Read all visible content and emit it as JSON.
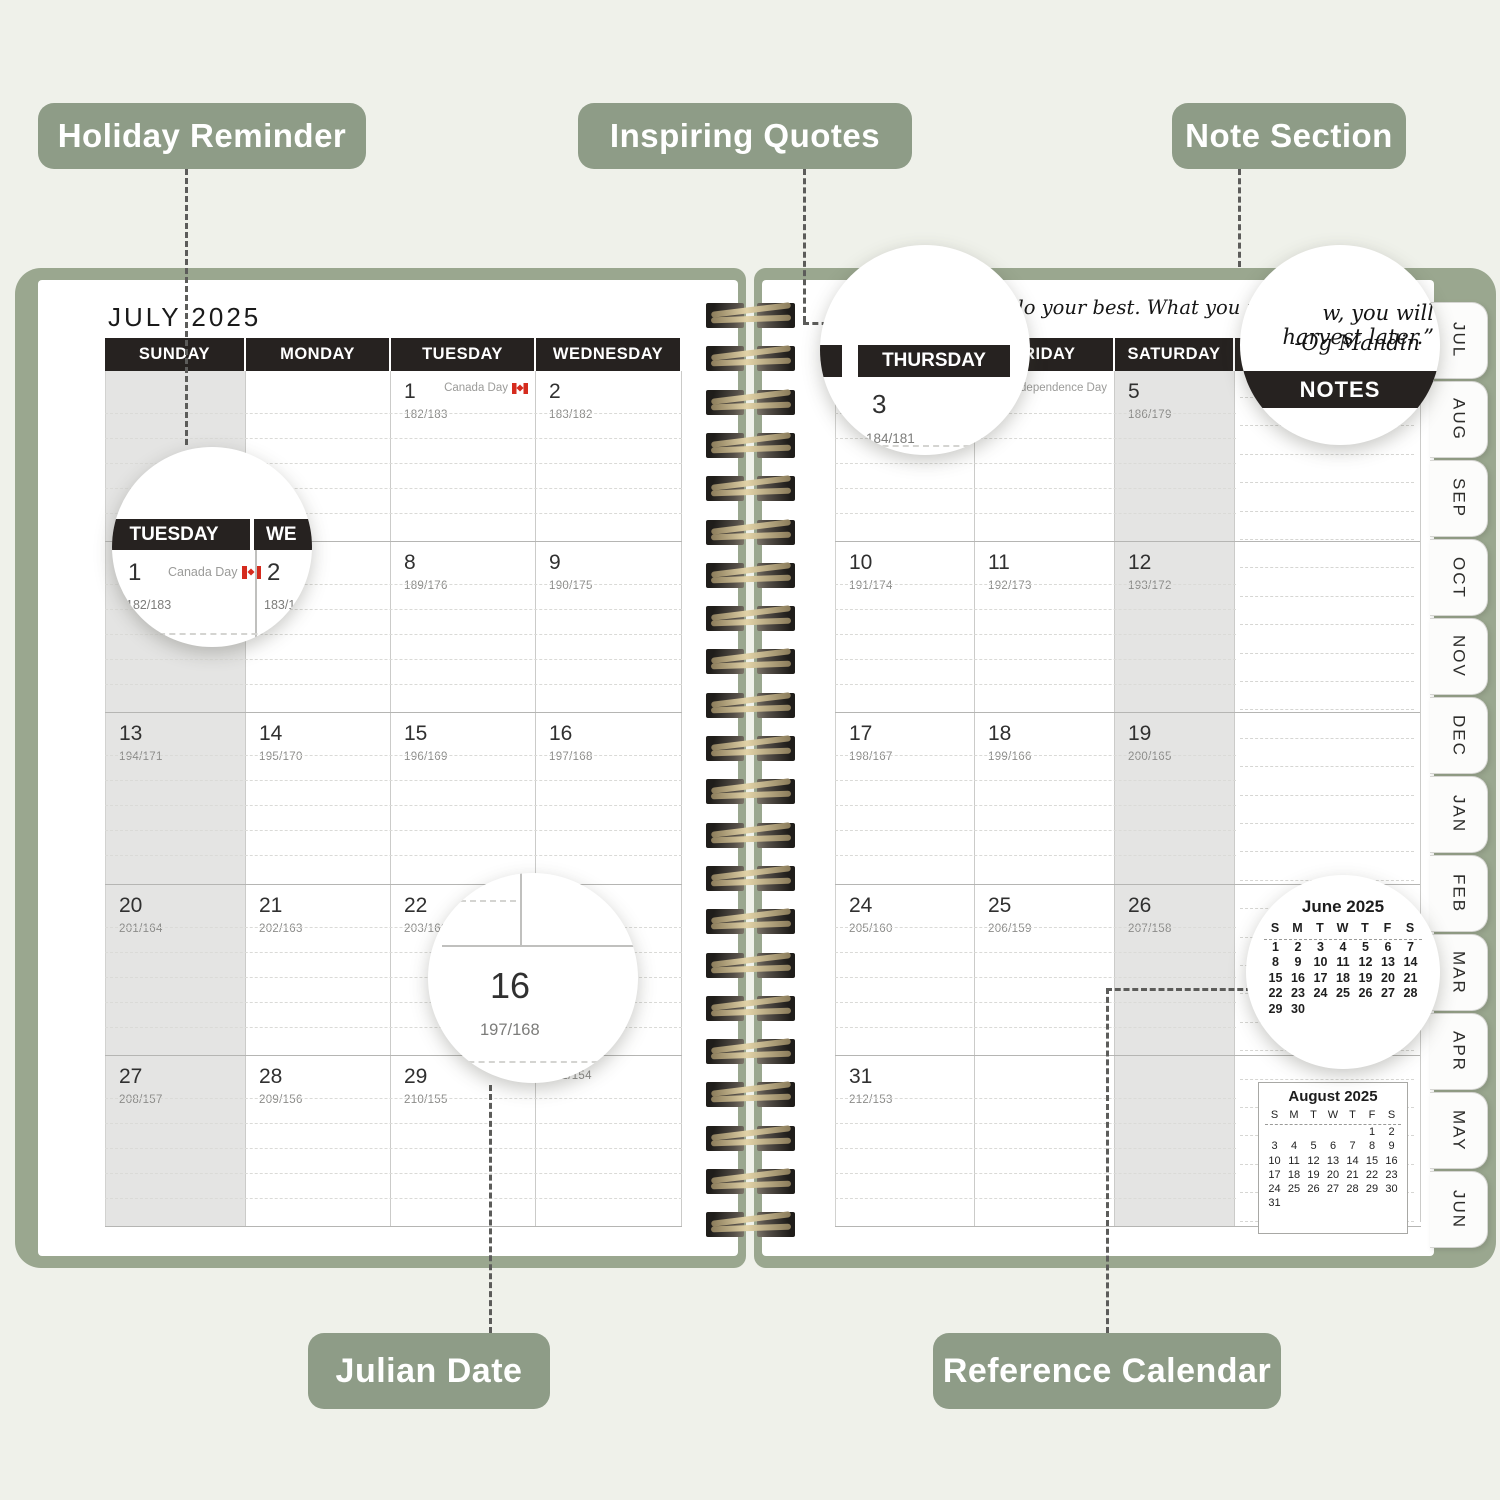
{
  "callouts": {
    "holiday_reminder": "Holiday Reminder",
    "inspiring_quotes": "Inspiring Quotes",
    "note_section": "Note Section",
    "julian_date": "Julian Date",
    "reference_calendar": "Reference Calendar"
  },
  "colors": {
    "background": "#eff1ea",
    "label_sage": "#8e9c87",
    "cover_sage": "#9aa78f",
    "header_bar": "#262220",
    "shaded_column": "#e4e4e3",
    "flag_red": "#d52b1e"
  },
  "left_page": {
    "title": "JULY 2025",
    "day_headers": [
      "SUNDAY",
      "MONDAY",
      "TUESDAY",
      "WEDNESDAY"
    ],
    "rows": [
      [
        {
          "day": "",
          "julian": "",
          "holiday": ""
        },
        {
          "day": "",
          "julian": "",
          "holiday": ""
        },
        {
          "day": "1",
          "julian": "182/183",
          "holiday": "Canada Day",
          "flag": true
        },
        {
          "day": "2",
          "julian": "183/182",
          "holiday": ""
        }
      ],
      [
        {
          "day": "",
          "julian": "",
          "holiday": ""
        },
        {
          "day": "",
          "julian": "",
          "holiday": ""
        },
        {
          "day": "8",
          "julian": "189/176",
          "holiday": ""
        },
        {
          "day": "9",
          "julian": "190/175",
          "holiday": ""
        }
      ],
      [
        {
          "day": "13",
          "julian": "194/171",
          "holiday": ""
        },
        {
          "day": "14",
          "julian": "195/170",
          "holiday": ""
        },
        {
          "day": "15",
          "julian": "196/169",
          "holiday": ""
        },
        {
          "day": "16",
          "julian": "197/168",
          "holiday": ""
        }
      ],
      [
        {
          "day": "20",
          "julian": "201/164",
          "holiday": ""
        },
        {
          "day": "21",
          "julian": "202/163",
          "holiday": ""
        },
        {
          "day": "22",
          "julian": "203/162",
          "holiday": ""
        },
        {
          "day": "",
          "julian": "",
          "holiday": ""
        }
      ],
      [
        {
          "day": "27",
          "julian": "208/157",
          "holiday": ""
        },
        {
          "day": "28",
          "julian": "209/156",
          "holiday": ""
        },
        {
          "day": "29",
          "julian": "210/155",
          "holiday": ""
        },
        {
          "day": "",
          "julian": "211/154",
          "holiday": ""
        }
      ]
    ]
  },
  "right_page": {
    "quote_fragment": "s do your best. What you plant",
    "day_headers": [
      "THURSDAY",
      "FRIDAY",
      "SATURDAY"
    ],
    "notes_header": "NOTES",
    "rows": [
      [
        {
          "day": "3",
          "julian": "184/181",
          "holiday": ""
        },
        {
          "day": "",
          "julian": "",
          "holiday": "Independence Day"
        },
        {
          "day": "5",
          "julian": "186/179",
          "holiday": ""
        }
      ],
      [
        {
          "day": "10",
          "julian": "191/174",
          "holiday": ""
        },
        {
          "day": "11",
          "julian": "192/173",
          "holiday": ""
        },
        {
          "day": "12",
          "julian": "193/172",
          "holiday": ""
        }
      ],
      [
        {
          "day": "17",
          "julian": "198/167",
          "holiday": ""
        },
        {
          "day": "18",
          "julian": "199/166",
          "holiday": ""
        },
        {
          "day": "19",
          "julian": "200/165",
          "holiday": ""
        }
      ],
      [
        {
          "day": "24",
          "julian": "205/160",
          "holiday": ""
        },
        {
          "day": "25",
          "julian": "206/159",
          "holiday": ""
        },
        {
          "day": "26",
          "julian": "207/158",
          "holiday": ""
        }
      ],
      [
        {
          "day": "31",
          "julian": "212/153",
          "holiday": ""
        },
        {
          "day": "",
          "julian": "",
          "holiday": ""
        },
        {
          "day": "",
          "julian": "",
          "holiday": ""
        }
      ]
    ],
    "august_calendar": {
      "title": "August 2025",
      "day_letters": [
        "S",
        "M",
        "T",
        "W",
        "T",
        "F",
        "S"
      ],
      "weeks": [
        [
          "",
          "",
          "",
          "",
          "",
          "1",
          "2"
        ],
        [
          "3",
          "4",
          "5",
          "6",
          "7",
          "8",
          "9"
        ],
        [
          "10",
          "11",
          "12",
          "13",
          "14",
          "15",
          "16"
        ],
        [
          "17",
          "18",
          "19",
          "20",
          "21",
          "22",
          "23"
        ],
        [
          "24",
          "25",
          "26",
          "27",
          "28",
          "29",
          "30"
        ],
        [
          "31",
          "",
          "",
          "",
          "",
          "",
          ""
        ]
      ]
    }
  },
  "insets": {
    "tuesday": {
      "header": "TUESDAY",
      "header_partial": "WE",
      "day": "1",
      "holiday": "Canada Day",
      "julian": "182/183",
      "day2": "2",
      "julian2": "183/18"
    },
    "thursday": {
      "header": "THURSDAY",
      "day": "3",
      "julian": "184/181"
    },
    "notes": {
      "quote_line": "w, you will harvest later.”",
      "attribution": "-Og Mandin",
      "header": "NOTES"
    },
    "julian": {
      "day": "16",
      "julian": "197/168"
    },
    "june_calendar": {
      "title": "June 2025",
      "day_letters": [
        "S",
        "M",
        "T",
        "W",
        "T",
        "F",
        "S"
      ],
      "weeks": [
        [
          "1",
          "2",
          "3",
          "4",
          "5",
          "6",
          "7"
        ],
        [
          "8",
          "9",
          "10",
          "11",
          "12",
          "13",
          "14"
        ],
        [
          "15",
          "16",
          "17",
          "18",
          "19",
          "20",
          "21"
        ],
        [
          "22",
          "23",
          "24",
          "25",
          "26",
          "27",
          "28"
        ],
        [
          "29",
          "30",
          "",
          "",
          "",
          "",
          ""
        ]
      ]
    }
  },
  "tabs": [
    "JUL",
    "AUG",
    "SEP",
    "OCT",
    "NOV",
    "DEC",
    "JAN",
    "FEB",
    "MAR",
    "APR",
    "MAY",
    "JUN"
  ]
}
